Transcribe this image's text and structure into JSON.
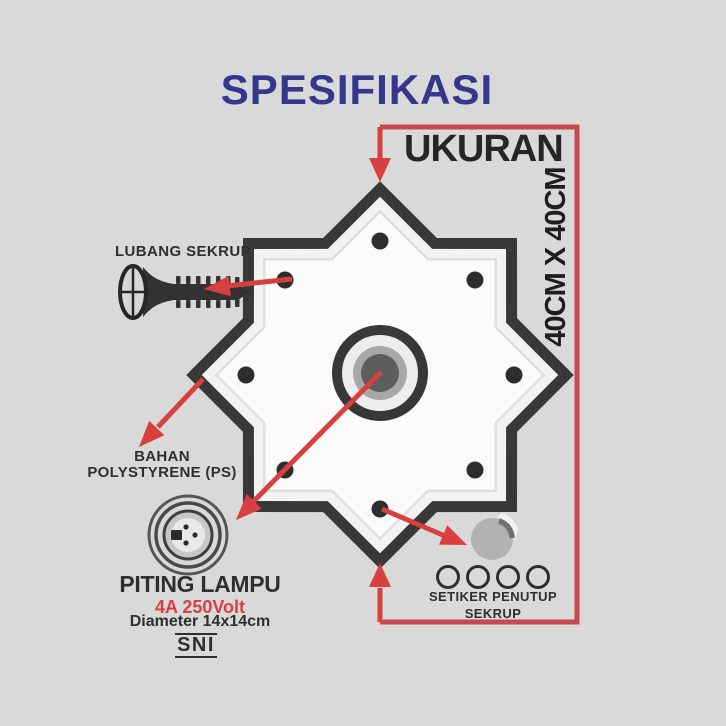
{
  "title": "SPESIFIKASI",
  "dimension": {
    "label": "UKURAN",
    "size": "40CM X 40CM"
  },
  "labels": {
    "screw_hole": "LUBANG SEKRUP",
    "material": {
      "line1": "BAHAN",
      "line2": "POLYSTYRENE (PS)"
    },
    "sticker": {
      "line1": "SETIKER PENUTUP",
      "line2": "SEKRUP"
    }
  },
  "socket": {
    "name": "PITING LAMPU",
    "rating": "4A 250Volt",
    "size": "Diameter 14x14cm",
    "certification": "SNI"
  },
  "icons": {
    "screw": "screw-icon",
    "lamp_socket": "lamp-socket-icon",
    "sticker": "sticker-peel-icon",
    "plate": "star-ceiling-plate",
    "cap_holes": "screw-cap-circles",
    "arrows": "red-callout-arrows"
  },
  "colors": {
    "background": "#d9d9d9",
    "title": "#34378c",
    "text": "#2f2f2f",
    "accent_red": "#d8403f",
    "bracket_red": "#c9484d",
    "plate_outline": "#383838"
  }
}
